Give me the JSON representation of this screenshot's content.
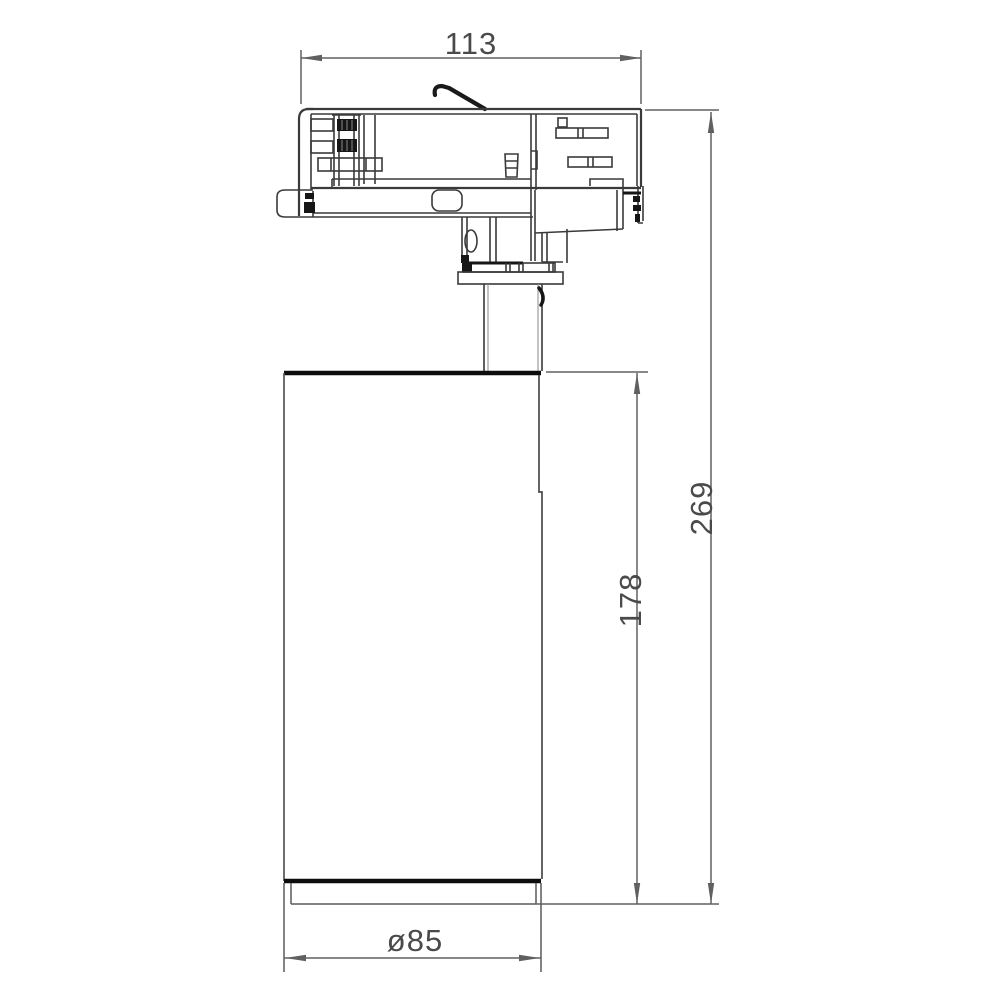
{
  "page": {
    "background": "#ffffff"
  },
  "drawing": {
    "type": "technical-dimension-drawing",
    "subject": "track-spotlight-side-view",
    "line_color": "#3a3a3a",
    "dim_color": "#606060",
    "dimensions": {
      "width_top": "113",
      "height_overall": "269",
      "height_body": "178",
      "diameter_body": "ø85"
    }
  }
}
